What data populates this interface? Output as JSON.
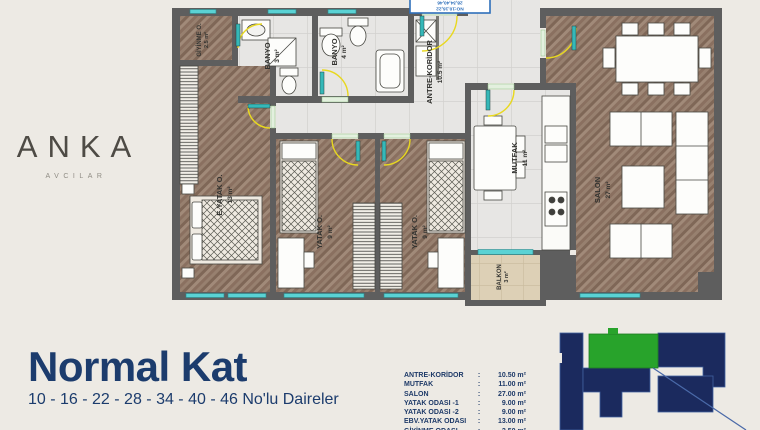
{
  "logo": {
    "letters": [
      "A",
      "N",
      "K",
      "A"
    ],
    "subtitle": "AVCILAR"
  },
  "title": {
    "heading": "Normal Kat",
    "subheading": "10 - 16 - 22 - 28 - 34 - 40 - 46 No'lu Daireler"
  },
  "floor_plan": {
    "door_sign": {
      "line1": "NO:10,16,22",
      "line2": "28,34,40,46"
    },
    "rooms": [
      {
        "id": "giyinme",
        "label": "GİYİNME O.",
        "area": "2.5 m²"
      },
      {
        "id": "banyo-small",
        "label": "BANYO",
        "area": "3 m²"
      },
      {
        "id": "banyo-large",
        "label": "BANYO",
        "area": "4 m²"
      },
      {
        "id": "antre-koridor",
        "label": "ANTRE-KORİDOR",
        "area": "10.5 m²"
      },
      {
        "id": "ebeveyn-yatak",
        "label": "E.YATAK O.",
        "area": "13 m²"
      },
      {
        "id": "yatak-1",
        "label": "YATAK O.",
        "area": "9 m²"
      },
      {
        "id": "yatak-2",
        "label": "YATAK O.",
        "area": "9 m²"
      },
      {
        "id": "mutfak",
        "label": "MUTFAK",
        "area": "11 m²"
      },
      {
        "id": "salon",
        "label": "SALON",
        "area": "27 m²"
      },
      {
        "id": "balkon",
        "label": "BALKON",
        "area": "3 m²"
      }
    ]
  },
  "legend": {
    "colon": ":",
    "rows": [
      {
        "label": "ANTRE-KORİDOR",
        "value": "10.50 m²"
      },
      {
        "label": "MUTFAK",
        "value": "11.00 m²"
      },
      {
        "label": "SALON",
        "value": "27.00 m²"
      },
      {
        "label": "YATAK ODASI -1",
        "value": "9.00 m²"
      },
      {
        "label": "YATAK ODASI -2",
        "value": "9.00 m²"
      },
      {
        "label": "EBV.YATAK ODASI",
        "value": "13.00 m²"
      },
      {
        "label": "GİYİNME ODASI",
        "value": "2.50 m²"
      }
    ]
  },
  "key_plan": {
    "building_color": "#1b2a5e",
    "highlight_color": "#28a32b",
    "outline_color": "#41619f"
  },
  "colors": {
    "background": "#edeae4",
    "navy": "#1c3c6d",
    "wall": "#5e5e5e",
    "window": "#5ad2d4",
    "door_arc": "#e8d81f"
  }
}
